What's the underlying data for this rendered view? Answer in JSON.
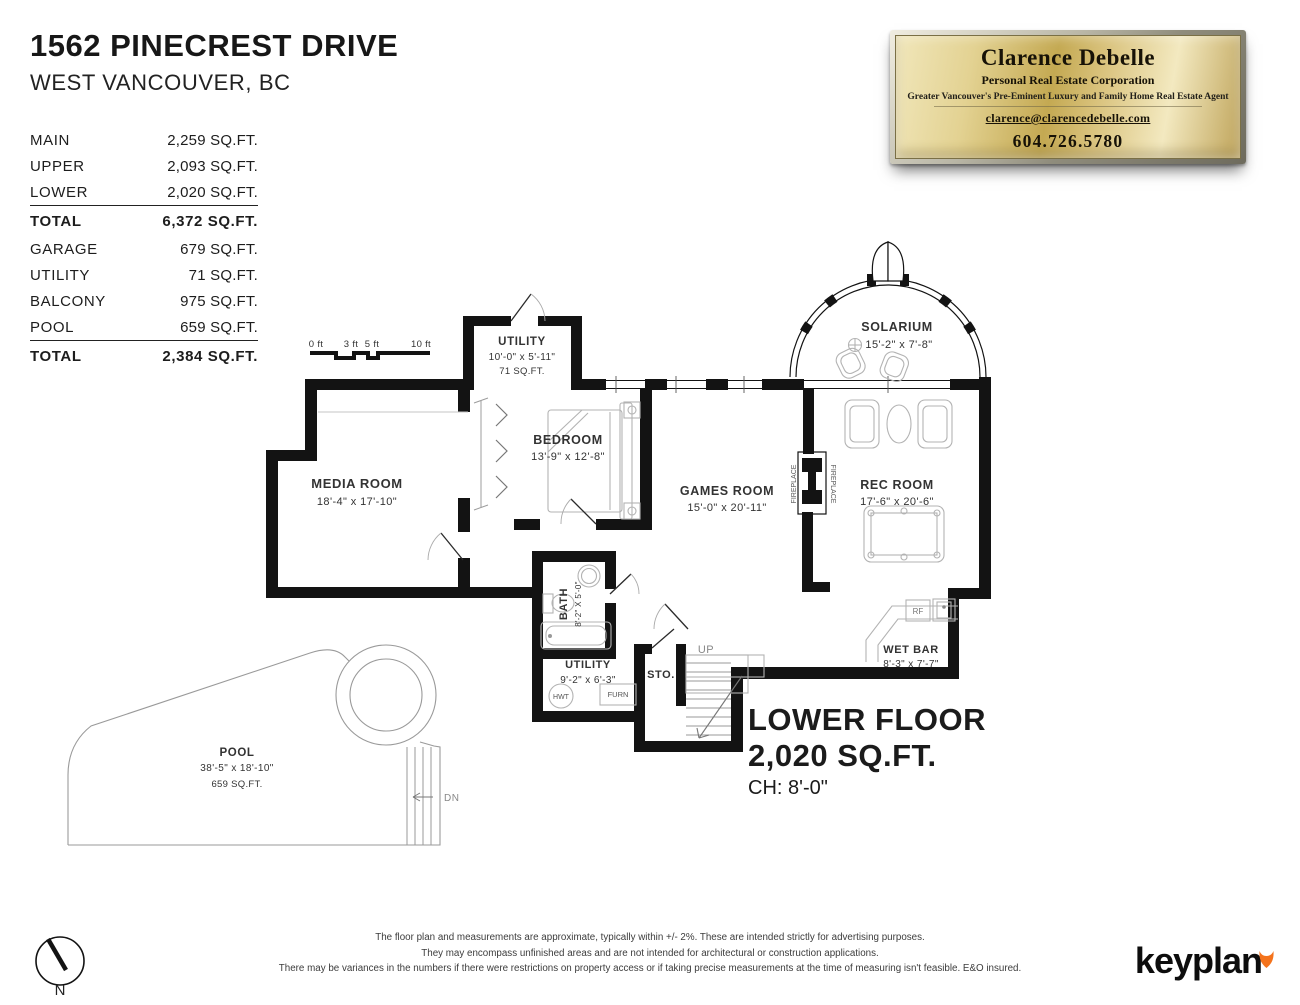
{
  "header": {
    "address": "1562 PINECREST DRIVE",
    "city": "WEST VANCOUVER, BC"
  },
  "area_table": {
    "main_rows": [
      {
        "label": "MAIN",
        "value": "2,259 SQ.FT."
      },
      {
        "label": "UPPER",
        "value": "2,093 SQ.FT."
      },
      {
        "label": "LOWER",
        "value": "2,020 SQ.FT."
      }
    ],
    "main_total": {
      "label": "TOTAL",
      "value": "6,372 SQ.FT."
    },
    "extra_rows": [
      {
        "label": "GARAGE",
        "value": "679 SQ.FT."
      },
      {
        "label": "UTILITY",
        "value": "71 SQ.FT."
      },
      {
        "label": "BALCONY",
        "value": "975 SQ.FT."
      },
      {
        "label": "POOL",
        "value": "659 SQ.FT."
      }
    ],
    "extra_total": {
      "label": "TOTAL",
      "value": "2,384 SQ.FT."
    }
  },
  "plaque": {
    "name": "Clarence Debelle",
    "title": "Personal Real Estate Corporation",
    "tagline": "Greater Vancouver's Pre-Eminent Luxury and Family Home Real Estate Agent",
    "email": "clarence@clarencedebelle.com",
    "phone": "604.726.5780",
    "gold_color": "#c4a952"
  },
  "floorplan": {
    "scale_labels": [
      "0 ft",
      "3 ft",
      "5 ft",
      "10 ft"
    ],
    "rooms": {
      "utility_top": {
        "name": "UTILITY",
        "dims": "10'-0\" x 5'-11\"",
        "area": "71 SQ.FT."
      },
      "media": {
        "name": "MEDIA ROOM",
        "dims": "18'-4\" x 17'-10\""
      },
      "bedroom": {
        "name": "BEDROOM",
        "dims": "13'-9\" x 12'-8\""
      },
      "games": {
        "name": "GAMES ROOM",
        "dims": "15'-0\" x 20'-11\""
      },
      "rec": {
        "name": "REC ROOM",
        "dims": "17'-6\" x 20'-6\""
      },
      "solarium": {
        "name": "SOLARIUM",
        "dims": "15'-2\" x 7'-8\""
      },
      "bath": {
        "name": "BATH",
        "dims": "8'-2\" X 5'-0\""
      },
      "utility_lower": {
        "name": "UTILITY",
        "dims": "9'-2\" x 6'-3\""
      },
      "wetbar": {
        "name": "WET BAR",
        "dims": "8'-3\" x 7'-7\""
      },
      "storage": {
        "name": "STO."
      },
      "pool": {
        "name": "POOL",
        "dims": "38'-5\" x 18'-10\"",
        "area": "659 SQ.FT."
      }
    },
    "labels": {
      "up": "UP",
      "dn": "DN",
      "hwt": "HWT",
      "furn": "FURN",
      "rf": "RF",
      "fireplace_left": "FIREPLACE",
      "fireplace_right": "FIREPLACE"
    }
  },
  "floor_title": {
    "line1": "LOWER FLOOR",
    "line2": "2,020 SQ.FT.",
    "line3": "CH: 8'-0\""
  },
  "footer": {
    "disclaimer": [
      "The floor plan and measurements are approximate, typically within +/- 2%. These are intended strictly for advertising purposes.",
      "They may encompass unfinished areas and are not intended for architectural or construction applications.",
      "There may be variances in the numbers if there were restrictions on property access or if taking precise measurements at the time of measuring isn't feasible. E&O insured."
    ],
    "north": "N",
    "brand": "keyplan",
    "brand_color": "#f4731c"
  }
}
